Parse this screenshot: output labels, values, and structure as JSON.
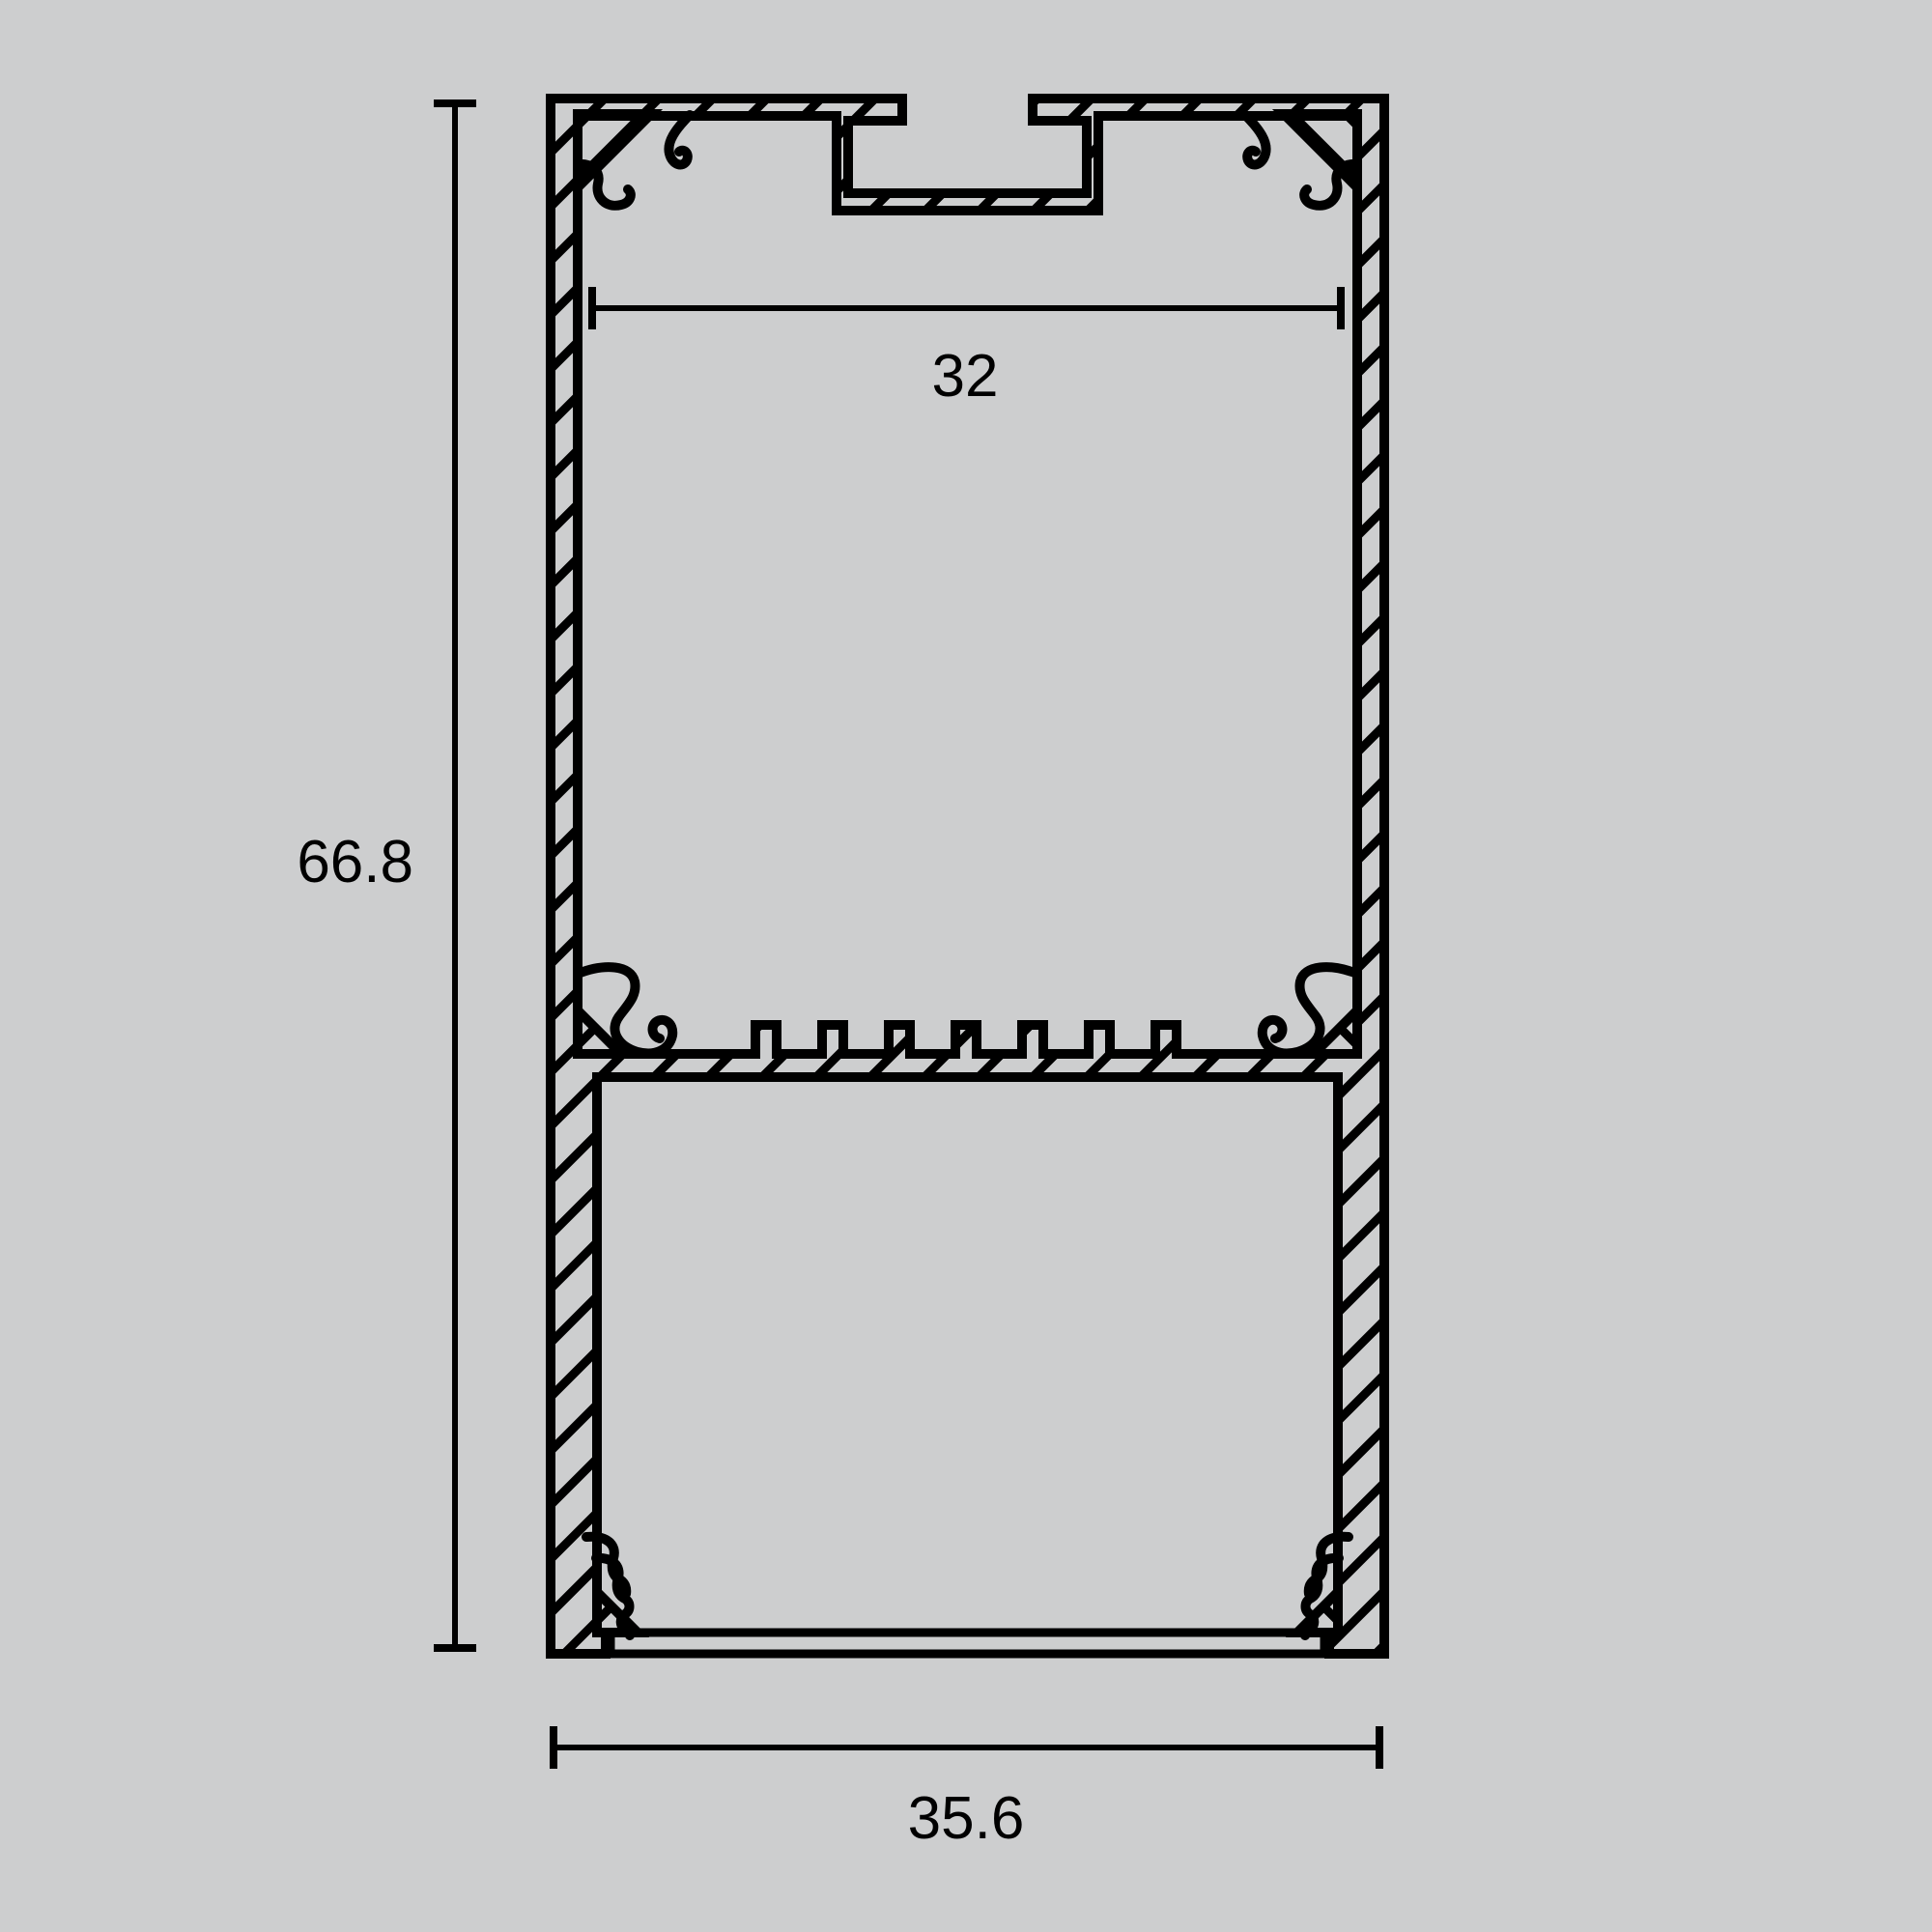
{
  "drawing": {
    "name": "aluminium-led-profile-cross-section",
    "background_color": "#cdcecf",
    "line_color": "#000000",
    "dimensions": {
      "height_label": "66.8",
      "inner_width_label": "32",
      "outer_width_label": "35.6"
    }
  }
}
